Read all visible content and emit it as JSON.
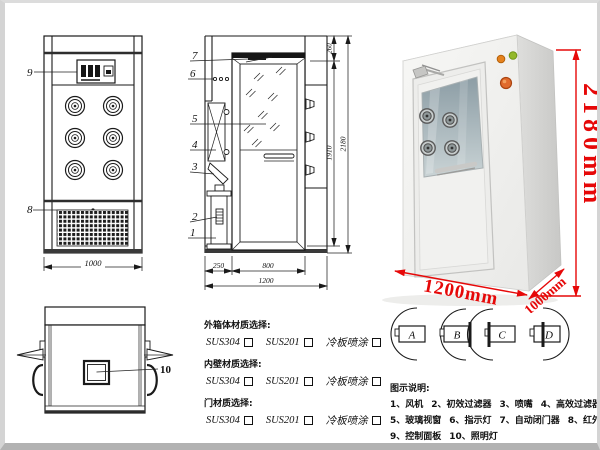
{
  "front_view": {
    "label_9": "9",
    "label_8": "8",
    "dim_width": "1000"
  },
  "side_view": {
    "label_7": "7",
    "label_6": "6",
    "label_5": "5",
    "label_4": "4",
    "label_3": "3",
    "label_2": "2",
    "label_1": "1",
    "dim_260": "260",
    "dim_1910": "1910",
    "dim_2180": "2180",
    "dim_250": "250",
    "dim_800": "800",
    "dim_1200": "1200"
  },
  "top_view": {
    "label_10": "10"
  },
  "photo": {
    "dim_height": "2180mm",
    "dim_width": "1200mm",
    "dim_depth": "1000mm",
    "annotation_color": "#e60808",
    "cabinet_color": "#f2f2f0"
  },
  "materials": {
    "sections": [
      {
        "title": "外箱体材质选择:",
        "options": [
          "SUS304",
          "SUS201",
          "冷板喷涂"
        ]
      },
      {
        "title": "内壁材质选择:",
        "options": [
          "SUS304",
          "SUS201",
          "冷板喷涂"
        ]
      },
      {
        "title": "门材质选择:",
        "options": [
          "SUS304",
          "SUS201",
          "冷板喷涂"
        ]
      }
    ]
  },
  "door_types": {
    "a": "A",
    "b": "B",
    "c": "C",
    "d": "D"
  },
  "legend": {
    "title": "图示说明:",
    "items": [
      "1、风机",
      "2、初效过滤器",
      "3、喷嘴",
      "4、高效过滤器",
      "5、玻璃视窗",
      "6、指示灯",
      "7、自动闭门器",
      "8、红外线感应器",
      "9、控制面板",
      "10、照明灯"
    ]
  }
}
